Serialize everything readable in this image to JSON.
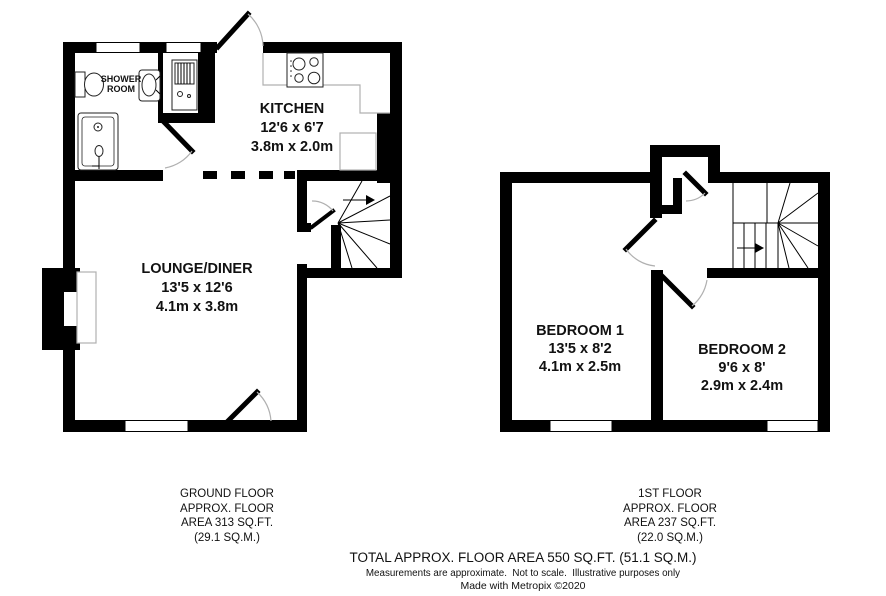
{
  "ground_floor": {
    "shower_room": {
      "line1": "SHOWER",
      "line2": "ROOM"
    },
    "kitchen": {
      "name": "KITCHEN",
      "dims_imperial": "12'6 x 6'7",
      "dims_metric": "3.8m x 2.0m"
    },
    "lounge_diner": {
      "name": "LOUNGE/DINER",
      "dims_imperial": "13'5 x 12'6",
      "dims_metric": "4.1m x 3.8m"
    },
    "area_label": {
      "line1": "GROUND FLOOR",
      "line2": "APPROX. FLOOR",
      "line3": "AREA 313 SQ.FT.",
      "line4": "(29.1 SQ.M.)"
    }
  },
  "first_floor": {
    "bedroom_1": {
      "name": "BEDROOM 1",
      "dims_imperial": "13'5 x 8'2",
      "dims_metric": "4.1m x 2.5m"
    },
    "bedroom_2": {
      "name": "BEDROOM 2",
      "dims_imperial": "9'6 x 8'",
      "dims_metric": "2.9m x 2.4m"
    },
    "area_label": {
      "line1": "1ST FLOOR",
      "line2": "APPROX. FLOOR",
      "line3": "AREA 237 SQ.FT.",
      "line4": "(22.0 SQ.M.)"
    }
  },
  "footer": {
    "total_area": "TOTAL APPROX. FLOOR AREA 550 SQ.FT. (51.1 SQ.M.)",
    "disclaimer": "Measurements are approximate.  Not to scale.  Illustrative purposes only",
    "credit": "Made with Metropix ©2020"
  },
  "colors": {
    "wall": "#000000",
    "counter_outline": "#b0b0b0",
    "door_arc": "#b0b0b0",
    "text": "#111111"
  }
}
